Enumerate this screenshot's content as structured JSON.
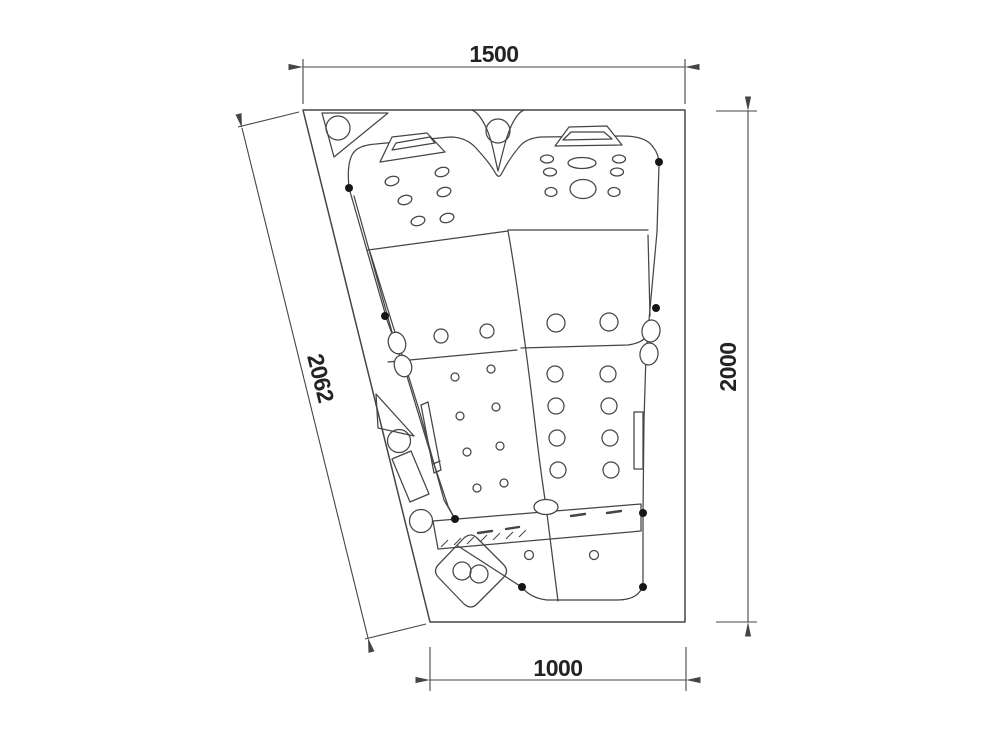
{
  "drawing": {
    "description": "Top-view technical plan drawing of a two-seat corner bathtub with jets, headrests, control panel and drain, annotated with four dimension lines",
    "dimensions": {
      "top": "1500",
      "right": "2000",
      "diagonal": "2062",
      "bottom": "1000"
    },
    "colors": {
      "line": "#454545",
      "dot": "#161616",
      "text": "#232323",
      "background": "#ffffff"
    }
  }
}
